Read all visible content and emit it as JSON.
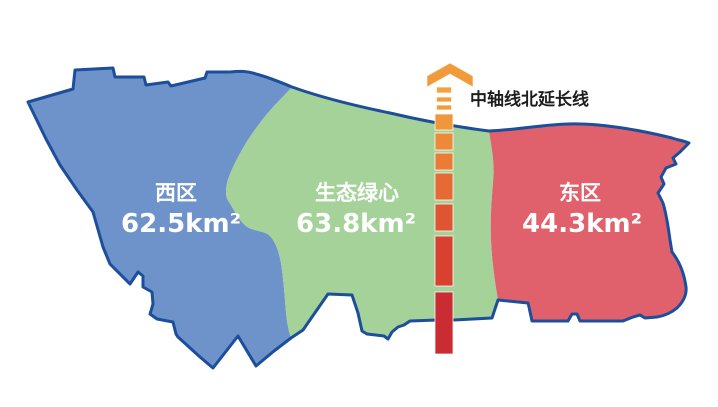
{
  "map": {
    "border_color": "#1D4E9B",
    "label_color": "#FFFFFF",
    "regions": [
      {
        "id": "west",
        "name": "西区",
        "area": "62.5km²",
        "fill": "#6E93CB"
      },
      {
        "id": "green-heart",
        "name": "生态绿心",
        "area": "63.8km²",
        "fill": "#A5D299"
      },
      {
        "id": "east",
        "name": "东区",
        "area": "44.3km²",
        "fill": "#E0616B"
      }
    ]
  },
  "axis": {
    "label": "中轴线北延长线",
    "label_color": "#1E1E1E",
    "arrow_color": "#F09A3A",
    "center_x": 444,
    "segments": [
      {
        "y": 87,
        "h": 6,
        "w": 15,
        "color": "#F5A23E"
      },
      {
        "y": 97,
        "h": 5,
        "w": 15,
        "color": "#F49E3B"
      },
      {
        "y": 105,
        "h": 5,
        "w": 15,
        "color": "#F39A3A"
      },
      {
        "y": 114,
        "h": 16,
        "w": 18,
        "color": "#F09739"
      },
      {
        "y": 133,
        "h": 17,
        "w": 18,
        "color": "#EE8A37"
      },
      {
        "y": 153,
        "h": 17,
        "w": 18,
        "color": "#EA7C35"
      },
      {
        "y": 173,
        "h": 27,
        "w": 18,
        "color": "#E56A33"
      },
      {
        "y": 204,
        "h": 27,
        "w": 18,
        "color": "#E05531"
      },
      {
        "y": 236,
        "h": 50,
        "w": 18,
        "color": "#D8402F"
      },
      {
        "y": 292,
        "h": 62,
        "w": 18,
        "color": "#CB2B33"
      }
    ]
  }
}
